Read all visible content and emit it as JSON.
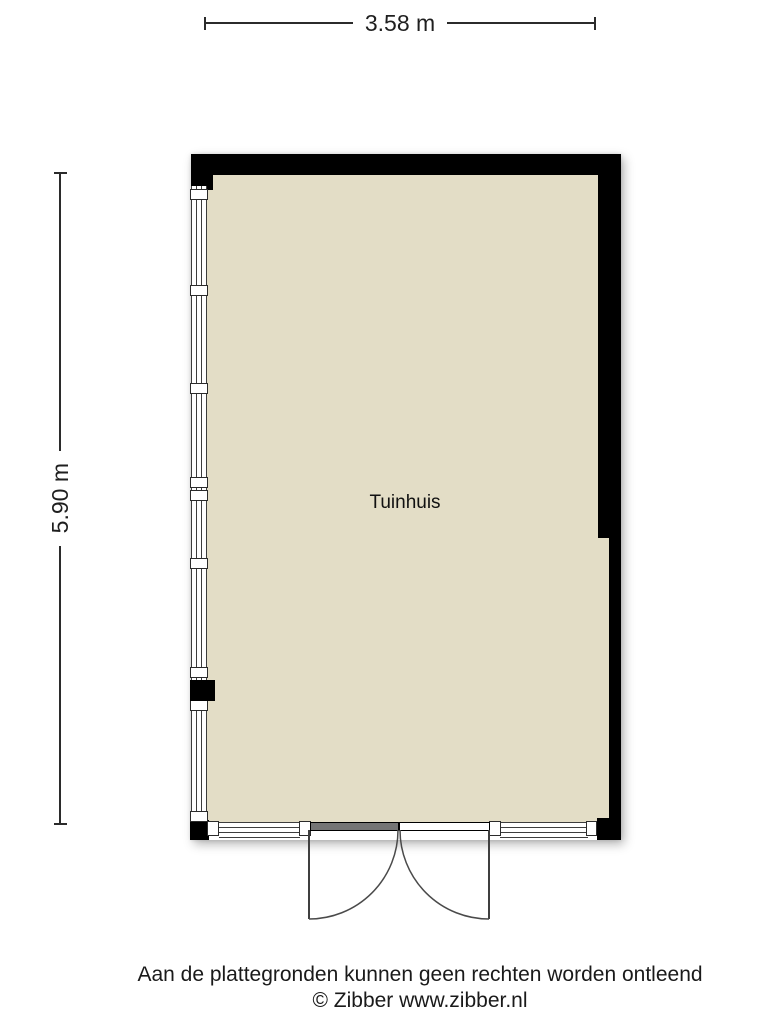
{
  "page": {
    "background": "#ffffff"
  },
  "dimensions": {
    "width": {
      "label": "3.58 m"
    },
    "height": {
      "label": "5.90 m"
    }
  },
  "plan": {
    "room": {
      "label": "Tuinhuis"
    },
    "colors": {
      "wall": "#000000",
      "floor": "#e3ddc6",
      "window_frame": "#3d3d3d",
      "dimension_line": "#2b2b2b",
      "door_leaf_closed": "#757575"
    }
  },
  "footer": {
    "disclaimer": "Aan de plattegronden kunnen geen rechten worden ontleend",
    "copyright": "© Zibber www.zibber.nl"
  }
}
